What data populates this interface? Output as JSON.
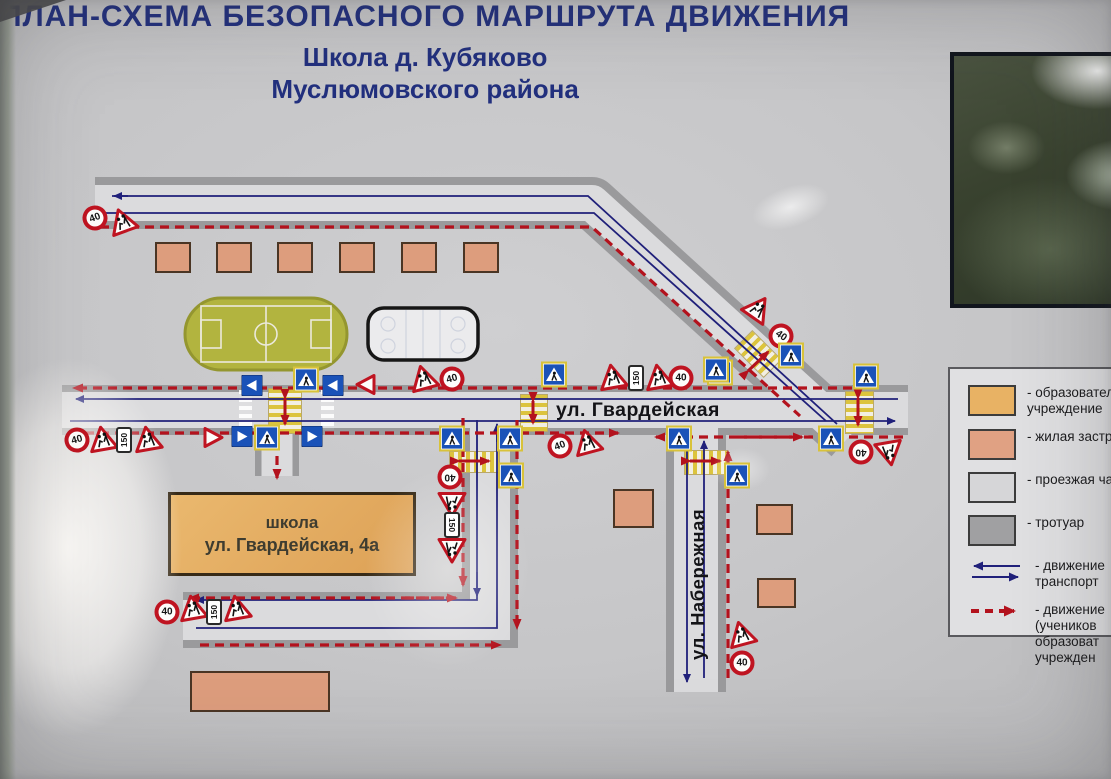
{
  "title": {
    "line1": "ПЛАН-СХЕМА БЕЗОПАСНОГО МАРШРУТА ДВИЖЕНИЯ",
    "line2": "Школа д. Кубяково",
    "line3": "Муслюмовского района"
  },
  "map": {
    "street_labels": {
      "gvardeyskaya": "ул. Гвардейская",
      "naberezhnaya": "ул. Набережная"
    },
    "school": {
      "line1": "школа",
      "line2": "ул. Гвардейская, 4а"
    },
    "sign_labels": {
      "speed": "40",
      "distance": "150"
    },
    "signs": [
      {
        "type": "s40",
        "x": 95,
        "y": 218,
        "rot": -20
      },
      {
        "type": "children",
        "x": 123,
        "y": 223,
        "rot": -20
      },
      {
        "type": "bluearrow",
        "x": 252,
        "y": 383,
        "rot": 180
      },
      {
        "type": "cross",
        "x": 306,
        "y": 382,
        "rot": 0
      },
      {
        "type": "bluearrow",
        "x": 333,
        "y": 383,
        "rot": 180
      },
      {
        "type": "giveway",
        "x": 366,
        "y": 382,
        "rot": 180
      },
      {
        "type": "children",
        "x": 424,
        "y": 380,
        "rot": -15
      },
      {
        "type": "s40",
        "x": 452,
        "y": 379,
        "rot": -15
      },
      {
        "type": "cross",
        "x": 554,
        "y": 377,
        "rot": 0
      },
      {
        "type": "children",
        "x": 613,
        "y": 379,
        "rot": -10
      },
      {
        "type": "d150",
        "x": 636,
        "y": 378,
        "rot": 0
      },
      {
        "type": "children",
        "x": 659,
        "y": 379,
        "rot": -10
      },
      {
        "type": "s40",
        "x": 681,
        "y": 378,
        "rot": 0
      },
      {
        "type": "cross",
        "x": 720,
        "y": 375,
        "rot": 0
      },
      {
        "type": "children",
        "x": 757,
        "y": 310,
        "rot": 35
      },
      {
        "type": "s40",
        "x": 781,
        "y": 336,
        "rot": 35
      },
      {
        "type": "cross",
        "x": 791,
        "y": 358,
        "rot": 0
      },
      {
        "type": "cross",
        "x": 716,
        "y": 372,
        "rot": 0
      },
      {
        "type": "cross",
        "x": 866,
        "y": 379,
        "rot": 0
      },
      {
        "type": "cross",
        "x": 831,
        "y": 441,
        "rot": 0
      },
      {
        "type": "s40",
        "x": 861,
        "y": 452,
        "rot": 180
      },
      {
        "type": "children",
        "x": 889,
        "y": 451,
        "rot": 170
      },
      {
        "type": "s40",
        "x": 77,
        "y": 440,
        "rot": -15
      },
      {
        "type": "children",
        "x": 103,
        "y": 441,
        "rot": -10
      },
      {
        "type": "d150",
        "x": 124,
        "y": 440,
        "rot": 0
      },
      {
        "type": "children",
        "x": 148,
        "y": 441,
        "rot": -10
      },
      {
        "type": "giveway",
        "x": 213,
        "y": 440,
        "rot": 0
      },
      {
        "type": "bluearrow",
        "x": 242,
        "y": 439,
        "rot": 0
      },
      {
        "type": "cross",
        "x": 267,
        "y": 440,
        "rot": 0
      },
      {
        "type": "bluearrow",
        "x": 312,
        "y": 439,
        "rot": 0
      },
      {
        "type": "s40",
        "x": 560,
        "y": 446,
        "rot": -20
      },
      {
        "type": "children",
        "x": 588,
        "y": 444,
        "rot": -15
      },
      {
        "type": "cross",
        "x": 452,
        "y": 441,
        "rot": 0
      },
      {
        "type": "s40",
        "x": 450,
        "y": 477,
        "rot": 180
      },
      {
        "type": "children",
        "x": 452,
        "y": 502,
        "rot": 180
      },
      {
        "type": "d150",
        "x": 452,
        "y": 525,
        "rot": 180
      },
      {
        "type": "children",
        "x": 452,
        "y": 548,
        "rot": 180
      },
      {
        "type": "cross",
        "x": 510,
        "y": 441,
        "rot": 0
      },
      {
        "type": "cross",
        "x": 511,
        "y": 478,
        "rot": 0
      },
      {
        "type": "cross",
        "x": 679,
        "y": 441,
        "rot": 0
      },
      {
        "type": "cross",
        "x": 737,
        "y": 478,
        "rot": 0
      },
      {
        "type": "children",
        "x": 742,
        "y": 636,
        "rot": -15
      },
      {
        "type": "s40",
        "x": 742,
        "y": 663,
        "rot": 0
      },
      {
        "type": "s40",
        "x": 167,
        "y": 612,
        "rot": 0
      },
      {
        "type": "children",
        "x": 193,
        "y": 610,
        "rot": -10
      },
      {
        "type": "d150",
        "x": 214,
        "y": 612,
        "rot": 0
      },
      {
        "type": "children",
        "x": 237,
        "y": 610,
        "rot": -10
      }
    ],
    "buildings": [
      [
        155,
        242,
        36,
        31
      ],
      [
        216,
        242,
        36,
        31
      ],
      [
        277,
        242,
        36,
        31
      ],
      [
        339,
        242,
        36,
        31
      ],
      [
        401,
        242,
        36,
        31
      ],
      [
        463,
        242,
        36,
        31
      ],
      [
        613,
        489,
        41,
        39
      ],
      [
        756,
        504,
        37,
        31
      ],
      [
        757,
        578,
        39,
        30
      ],
      [
        190,
        671,
        140,
        41
      ]
    ],
    "crosswalks": [
      {
        "x": 268,
        "y": 388,
        "w": 32,
        "h": 44,
        "dir": "h",
        "style": "yellow",
        "rot": 0
      },
      {
        "x": 520,
        "y": 394,
        "w": 26,
        "h": 36,
        "dir": "h",
        "style": "yellow",
        "rot": 0
      },
      {
        "x": 845,
        "y": 391,
        "w": 27,
        "h": 41,
        "dir": "h",
        "style": "yellow",
        "rot": 0
      },
      {
        "x": 684,
        "y": 450,
        "w": 42,
        "h": 23,
        "dir": "v",
        "style": "yellow",
        "rot": 0
      },
      {
        "x": 449,
        "y": 451,
        "w": 49,
        "h": 20,
        "dir": "v",
        "style": "yellow",
        "rot": 0
      },
      {
        "x": 737,
        "y": 341,
        "w": 40,
        "h": 24,
        "dir": "v",
        "style": "yellow",
        "rot": 45
      },
      {
        "x": 239,
        "y": 390,
        "w": 13,
        "h": 40,
        "dir": "h",
        "style": "white",
        "rot": 0
      },
      {
        "x": 321,
        "y": 390,
        "w": 13,
        "h": 40,
        "dir": "h",
        "style": "white",
        "rot": 0
      }
    ]
  },
  "legend": {
    "items": [
      {
        "graphic": "swatch",
        "color": "#e8b264",
        "label": "- образовател\nучреждение"
      },
      {
        "graphic": "swatch",
        "color": "#e0a183",
        "label": "- жилая застр"
      },
      {
        "graphic": "swatch",
        "color": "#d6d6d8",
        "label": "- проезжая ча"
      },
      {
        "graphic": "swatch",
        "color": "#a0a0a2",
        "label": "- тротуар"
      },
      {
        "graphic": "blue-arrows",
        "color": "#20207a",
        "label": "- движение\nтранспорт"
      },
      {
        "graphic": "red-dashed-arrow",
        "color": "#b3121d",
        "label": "- движение\n(учеников\nобразоват\nучрежден"
      }
    ]
  },
  "colors": {
    "title": "#22307e",
    "route": "#b3121d",
    "transport": "#20207a",
    "road_surface": "#dbdbdd",
    "sidewalk": "#9a9a9c",
    "educational": "#e8b264",
    "residential": "#dd9d7d"
  }
}
